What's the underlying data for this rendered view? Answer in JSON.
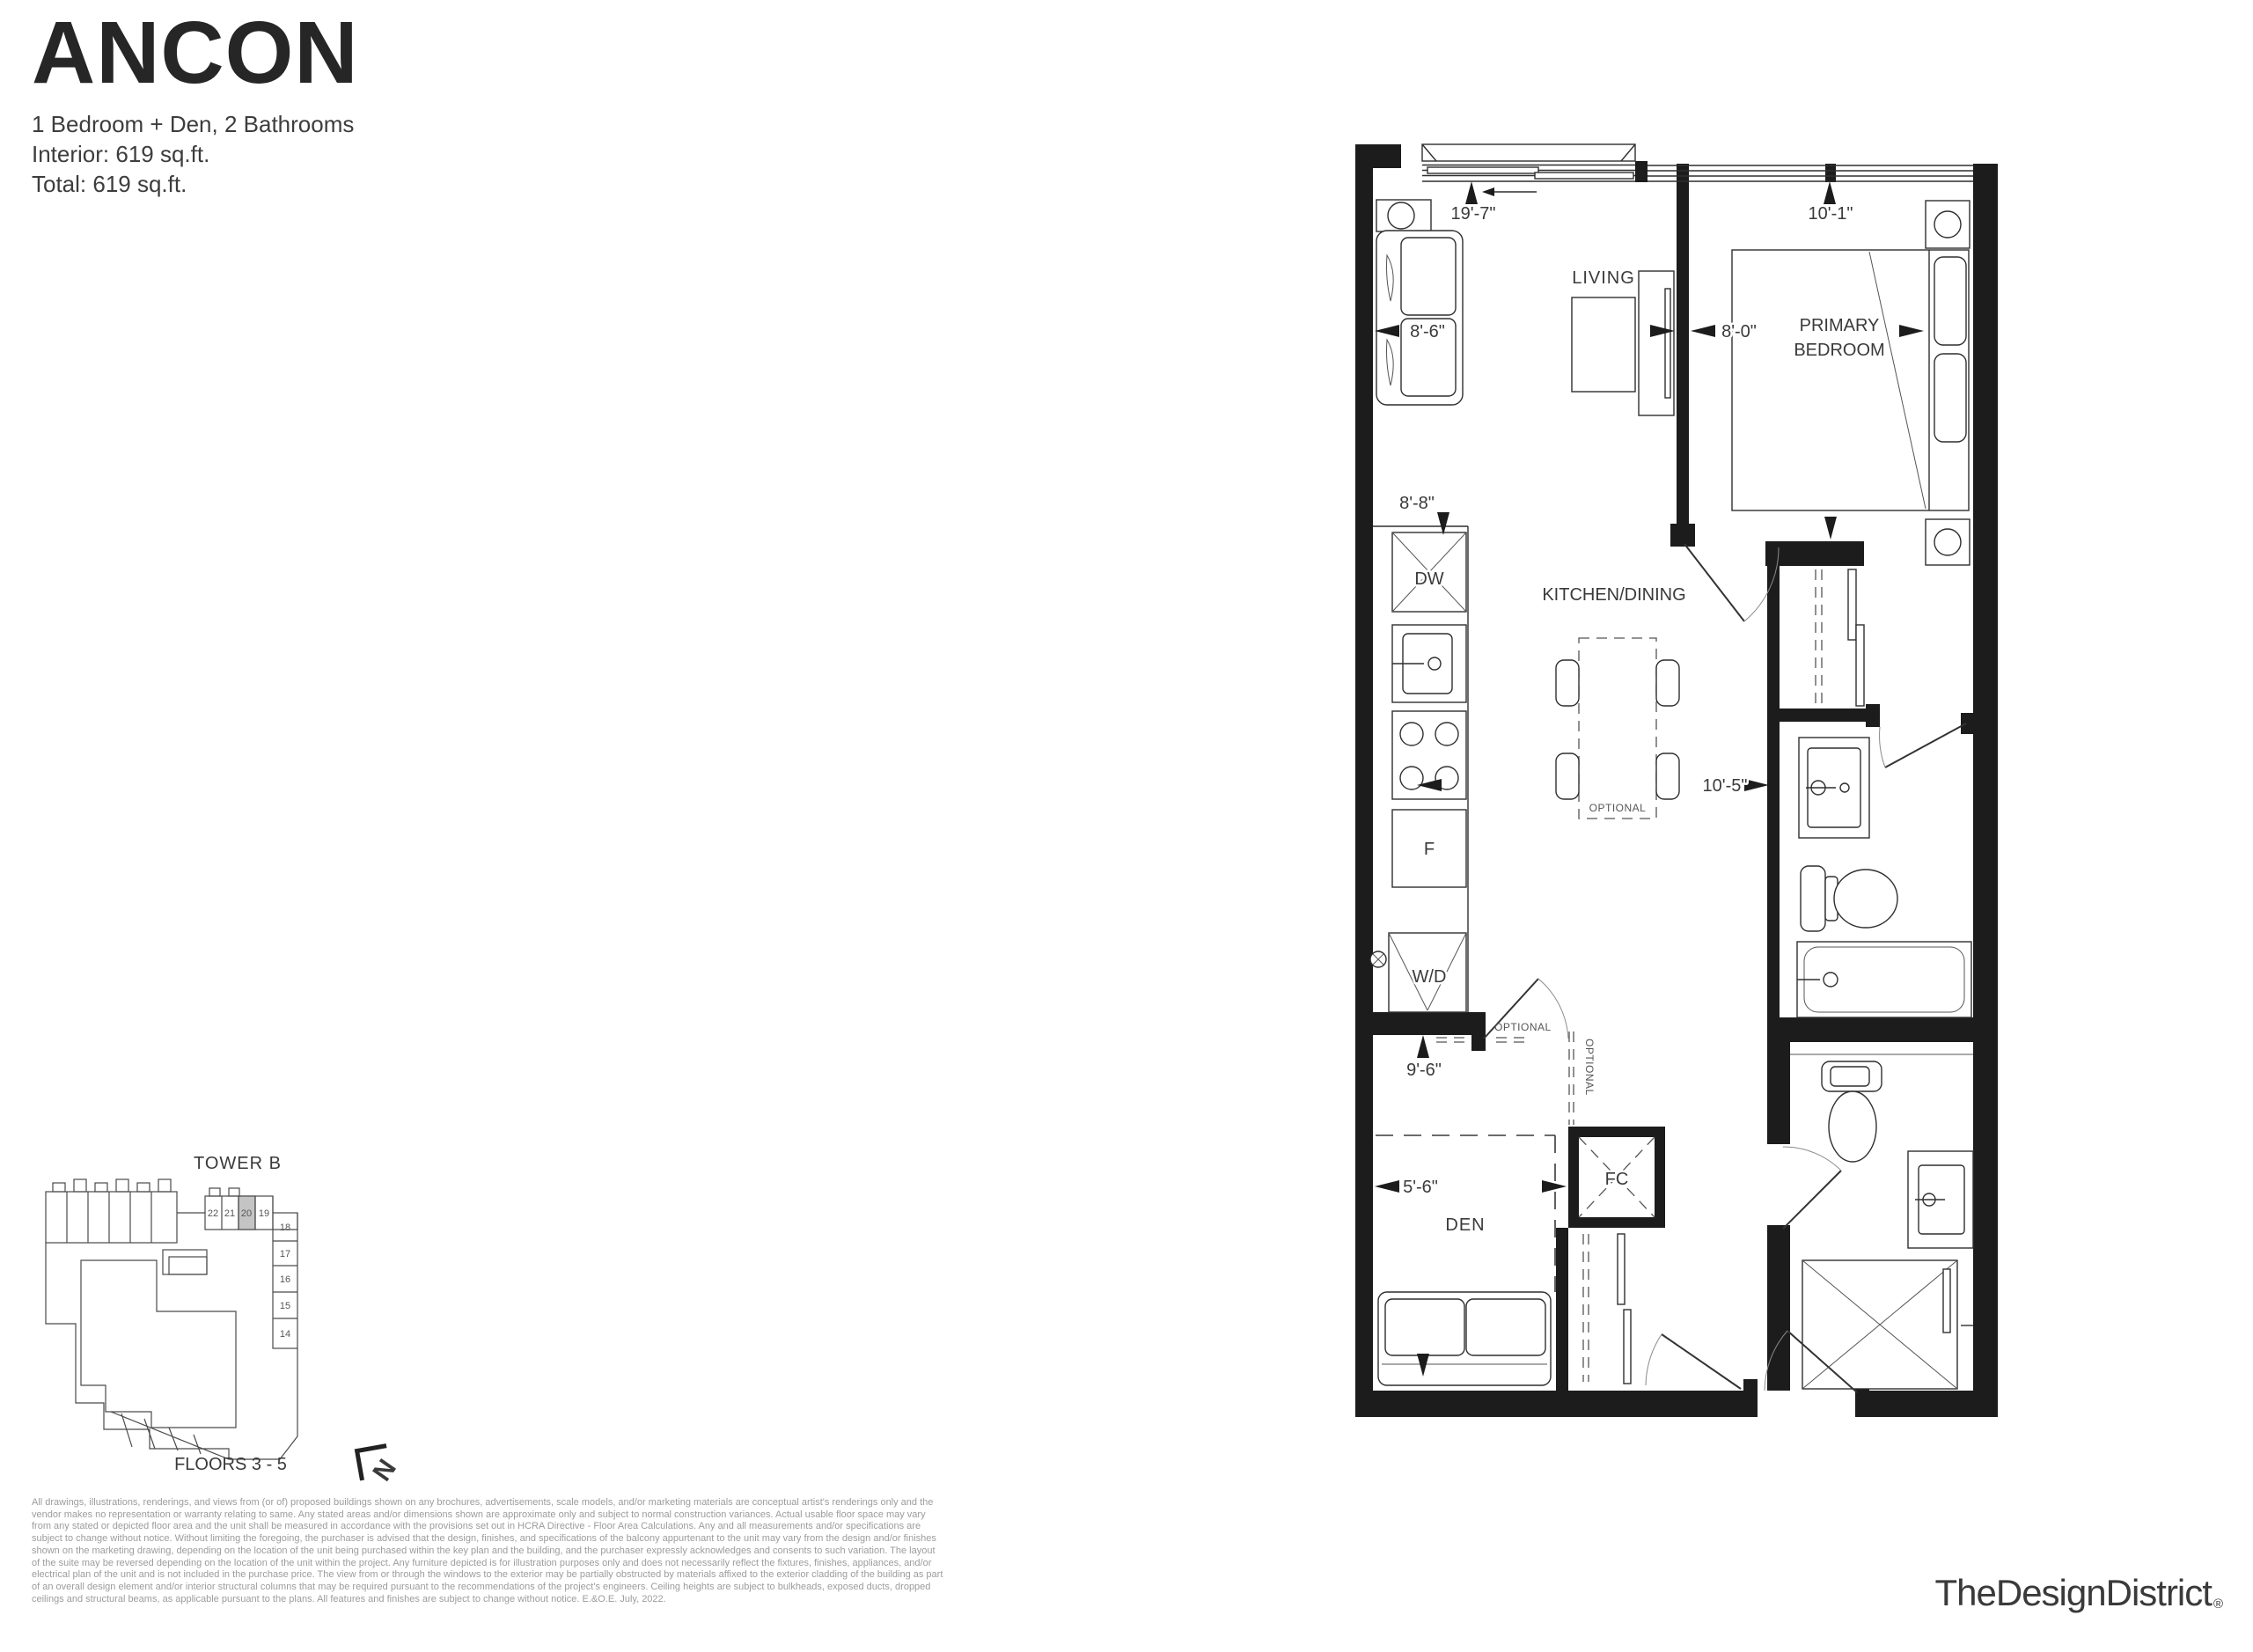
{
  "header": {
    "title": "ANCON",
    "subtitle": "1 Bedroom + Den, 2 Bathrooms",
    "interior": "Interior: 619 sq.ft.",
    "total": "Total: 619 sq.ft."
  },
  "plan": {
    "rooms": {
      "living": "LIVING",
      "primary_bedroom_line1": "PRIMARY",
      "primary_bedroom_line2": "BEDROOM",
      "kitchen_dining": "KITCHEN/DINING",
      "den": "DEN"
    },
    "dims": {
      "balcony": "19'-7\"",
      "bedroom_window": "10'-1\"",
      "living_width": "8'-6\"",
      "bedroom_depth": "8'-0\"",
      "kitchen_width": "8'-8\"",
      "kitchen_length": "10'-5\"",
      "den_length": "9'-6\"",
      "den_width": "5'-6\""
    },
    "fixtures": {
      "dishwasher": "DW",
      "fridge": "F",
      "washer_dryer": "W/D",
      "fan_coil": "FC"
    },
    "optional": "OPTIONAL"
  },
  "keyplan": {
    "tower": "TOWER B",
    "floors": "FLOORS 3 - 5",
    "north": "N",
    "units": [
      "22",
      "21",
      "20",
      "19",
      "18",
      "17",
      "16",
      "15",
      "14"
    ],
    "highlighted_unit": "20",
    "highlight_color": "#c4c4c4"
  },
  "disclaimer": {
    "lines": [
      "All drawings, illustrations, renderings, and views from (or of) proposed buildings shown on any brochures, advertisements, scale models, and/or marketing materials are conceptual artist's renderings only and the",
      "vendor makes no representation or warranty relating to same. Any stated areas and/or dimensions shown are approximate only and subject to normal construction variances. Actual usable floor space may vary",
      "from any stated or depicted floor area and the unit shall be measured in accordance with the provisions set out in HCRA Directive - Floor Area Calculations. Any and all measurements and/or specifications are",
      "subject to change without notice. Without limiting the foregoing, the purchaser is advised that the design, finishes, and specifications of the balcony appurtenant to the unit may vary from the design and/or finishes",
      "shown on the marketing drawing, depending on the location of the unit being purchased within the key plan and the building, and the purchaser expressly acknowledges and consents to such variation. The layout",
      "of the suite may be reversed depending on the location of the unit within the project. Any furniture depicted is for illustration purposes only and does not necessarily reflect the fixtures, finishes, appliances, and/or",
      "electrical plan of the unit and is not included in the purchase price. The view from or through the windows to the exterior may be partially obstructed by materials affixed to the exterior cladding of the building as part",
      "of an overall design element and/or interior structural columns that may be required pursuant to the recommendations of the project's engineers. Ceiling heights are subject to bulkheads, exposed ducts, dropped",
      "ceilings and structural beams, as applicable pursuant to the plans. All features and finishes are subject to change without notice. E.&O.E. July, 2022."
    ]
  },
  "footer": {
    "logo": "TheDesignDistrict",
    "registered": "®"
  }
}
